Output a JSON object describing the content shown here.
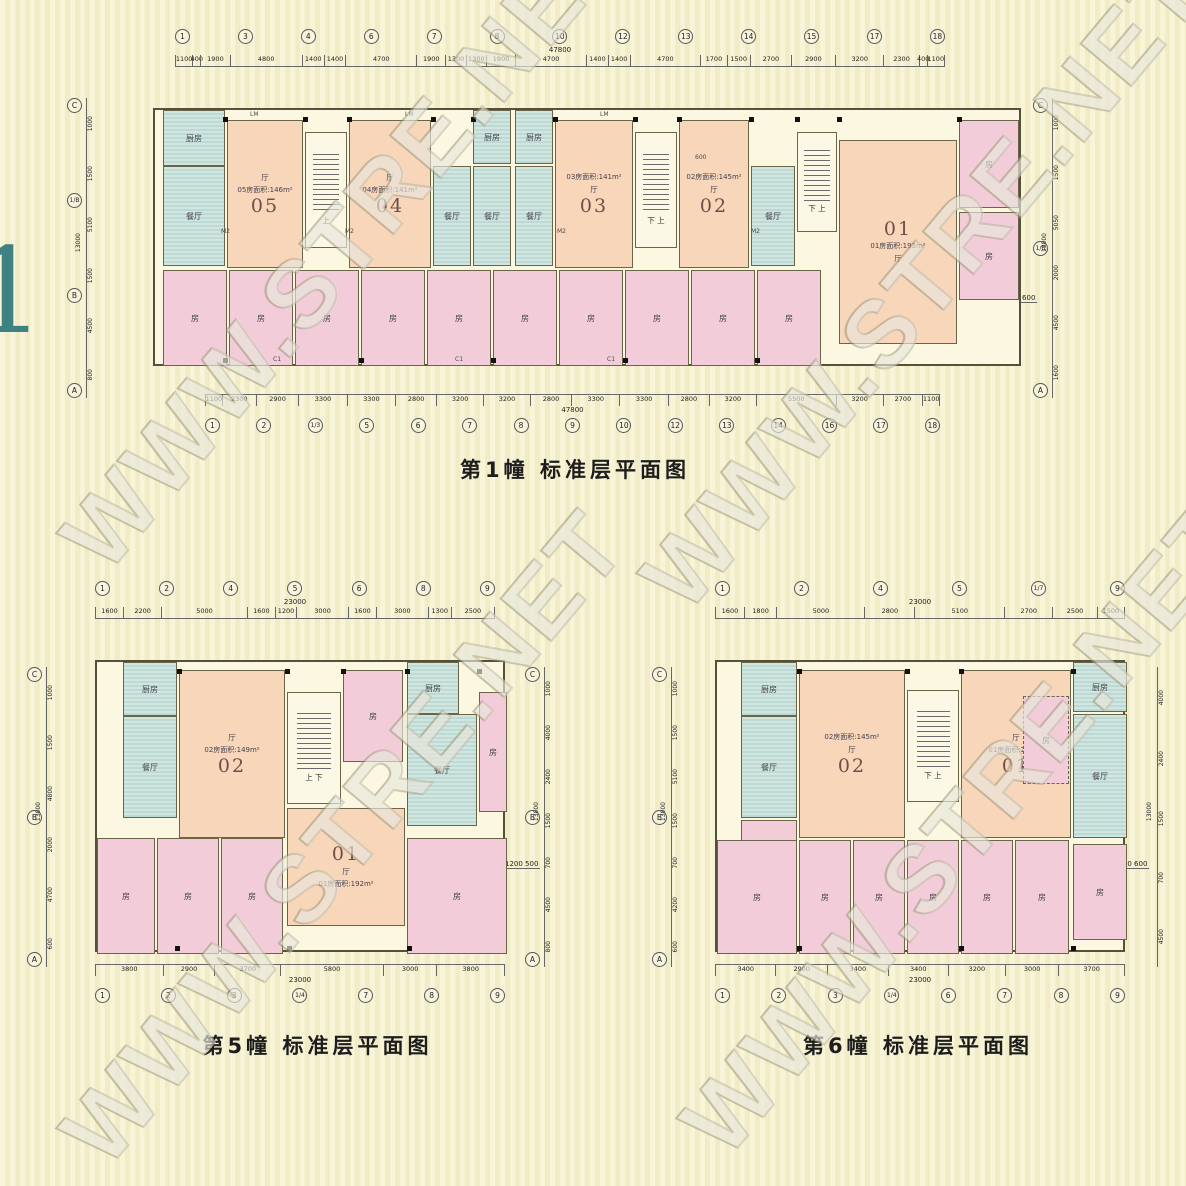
{
  "watermark": {
    "text": "WWW.STRE.NET"
  },
  "edge_glyph": "1",
  "labels": {
    "bedroom": "房",
    "hall": "厅",
    "dining": "餐厅",
    "kitchen": "厨房",
    "up": "上",
    "down_up": "下 上",
    "up_down": "上 下",
    "lm": "LM",
    "m2": "M2",
    "c1": "C1",
    "n600": "600"
  },
  "plans": [
    {
      "id": "building1",
      "title": "第1幢 标准层平面图",
      "top_axis": {
        "total": "47800",
        "dims": [
          "1100",
          "400",
          "1900",
          "4800",
          "1400",
          "1400",
          "4700",
          "1900",
          "1300",
          "1300",
          "1900",
          "4700",
          "1400",
          "1400",
          "4700",
          "1700",
          "1500",
          "2700",
          "2900",
          "3200",
          "2300",
          "400",
          "1100"
        ],
        "bubbles": [
          "1",
          "3",
          "4",
          "6",
          "7",
          "8",
          "10",
          "12",
          "13",
          "14",
          "15",
          "17",
          "18"
        ]
      },
      "bottom_axis": {
        "total": "47800",
        "dims": [
          "1100",
          "2300",
          "2900",
          "3300",
          "3300",
          "2800",
          "3200",
          "3200",
          "2800",
          "3300",
          "3300",
          "2800",
          "3200",
          "5500",
          "3200",
          "2700",
          "1100"
        ],
        "bubbles": [
          "1",
          "2",
          "1/3",
          "5",
          "6",
          "7",
          "8",
          "9",
          "10",
          "12",
          "13",
          "14",
          "16",
          "17",
          "18"
        ]
      },
      "left_axis": {
        "letters": [
          "C",
          "1/B",
          "B",
          "A"
        ],
        "dims": [
          "1000",
          "1500",
          "5100",
          "1500",
          "4500",
          "800"
        ],
        "note": "13000"
      },
      "right_axis": {
        "letters": [
          "C",
          "1/B",
          "A"
        ],
        "dims": [
          "1000",
          "1500",
          "5050",
          "2000",
          "4500",
          "1600"
        ],
        "note": "13000",
        "extra": "1200 600"
      },
      "units": [
        {
          "no": "05",
          "area": "05房面积:146m²"
        },
        {
          "no": "04",
          "area": "04房面积:141m²"
        },
        {
          "no": "03",
          "area": "03房面积:141m²"
        },
        {
          "no": "02",
          "area": "02房面积:145m²"
        },
        {
          "no": "01",
          "area": "01房面积:193m²"
        }
      ]
    },
    {
      "id": "building5",
      "title": "第5幢 标准层平面图",
      "top_axis": {
        "total": "23000",
        "dims": [
          "1600",
          "2200",
          "5000",
          "1600",
          "1200",
          "3000",
          "1600",
          "3000",
          "1300",
          "2500"
        ],
        "bubbles": [
          "1",
          "2",
          "4",
          "5",
          "6",
          "8",
          "9"
        ]
      },
      "bottom_axis": {
        "total": "23000",
        "dims": [
          "3800",
          "2900",
          "3700",
          "5800",
          "3000",
          "3800"
        ],
        "bubbles": [
          "1",
          "2",
          "3",
          "1/4",
          "7",
          "8",
          "9"
        ]
      },
      "left_axis": {
        "letters": [
          "C",
          "B",
          "A"
        ],
        "dims": [
          "1000",
          "1500",
          "4800",
          "2000",
          "4700",
          "600"
        ],
        "note": "13000"
      },
      "right_axis": {
        "letters": [
          "C",
          "B",
          "A"
        ],
        "dims": [
          "1000",
          "4000",
          "2400",
          "1500",
          "700",
          "4500",
          "800"
        ],
        "note": "13000",
        "extra": "1200 500"
      },
      "units": [
        {
          "no": "02",
          "area": "02房面积:149m²"
        },
        {
          "no": "01",
          "area": "01房面积:192m²"
        }
      ]
    },
    {
      "id": "building6",
      "title": "第6幢 标准层平面图",
      "top_axis": {
        "total": "23000",
        "dims": [
          "1600",
          "1800",
          "5000",
          "2800",
          "5100",
          "2700",
          "2500",
          "1500"
        ],
        "bubbles": [
          "1",
          "2",
          "4",
          "5",
          "1/7",
          "9"
        ]
      },
      "bottom_axis": {
        "total": "23000",
        "dims": [
          "3400",
          "2900",
          "3400",
          "3400",
          "3200",
          "3000",
          "3700"
        ],
        "bubbles": [
          "1",
          "2",
          "3",
          "1/4",
          "6",
          "7",
          "8",
          "9"
        ]
      },
      "left_axis": {
        "letters": [
          "C",
          "B",
          "A"
        ],
        "dims": [
          "1000",
          "1500",
          "5100",
          "1500",
          "700",
          "4200",
          "600"
        ],
        "note": "13000"
      },
      "right_axis": {
        "letters": [],
        "dims": [
          "4000",
          "2400",
          "1500",
          "700",
          "4500"
        ],
        "note": "13000",
        "extra": "1200 600"
      },
      "units": [
        {
          "no": "02",
          "area": "02房面积:145m²"
        },
        {
          "no": "01",
          "area": "01房面积:203m²"
        }
      ]
    }
  ]
}
